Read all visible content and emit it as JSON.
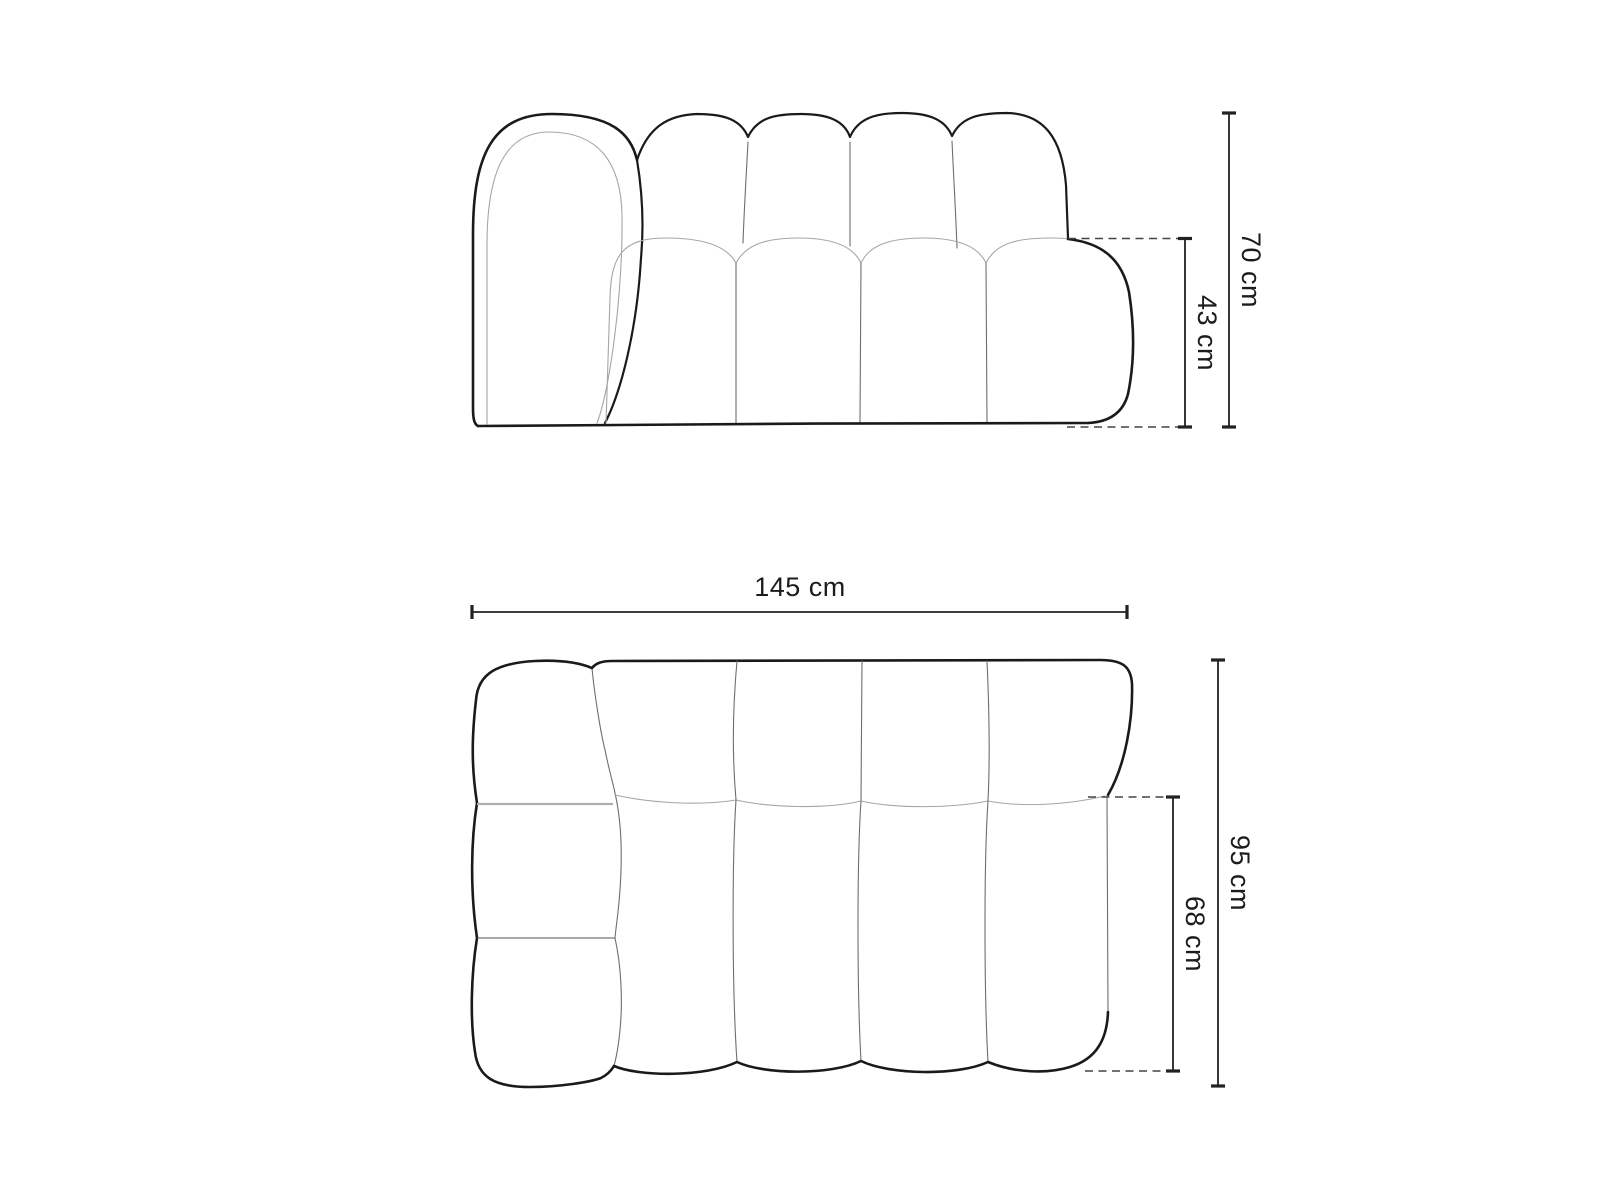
{
  "front_view": {
    "total_height_label": "70 cm",
    "seat_height_label": "43 cm"
  },
  "top_view": {
    "total_width_label": "145 cm",
    "total_depth_label": "95 cm",
    "seat_depth_label": "68 cm"
  },
  "colors": {
    "background": "#ffffff",
    "outline": "#1a1a1a",
    "seam": "#6e6e6e",
    "light_line": "#a6a6a6",
    "dimension_line": "#222222",
    "dashed_line": "#444444",
    "label_text": "#1c1c1c"
  }
}
